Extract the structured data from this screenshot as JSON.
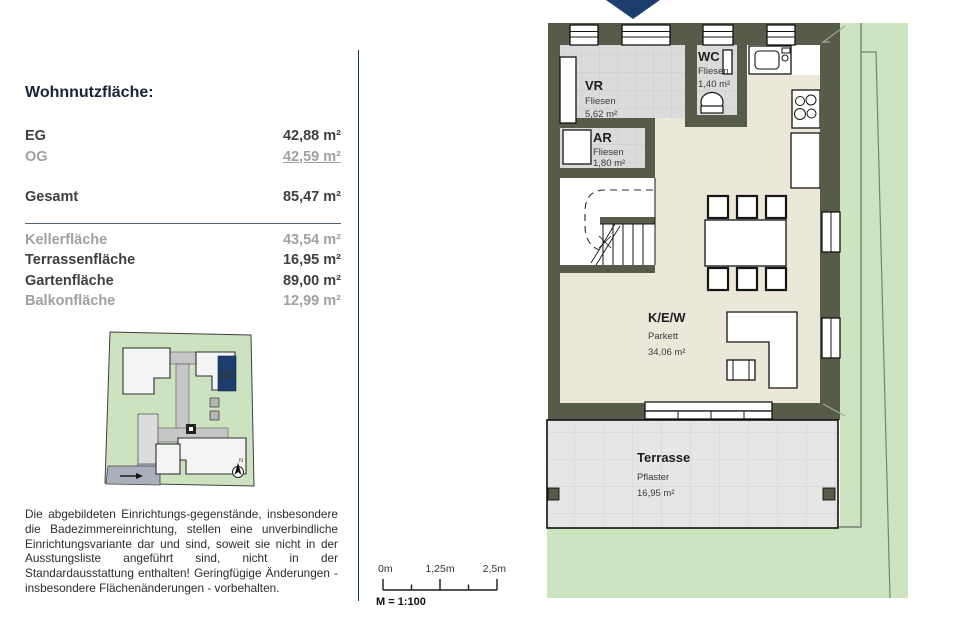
{
  "panel": {
    "title": "Wohnnutzfläche:",
    "rows": [
      {
        "label": "EG",
        "value": "42,88 m²"
      },
      {
        "label": "OG",
        "value": "42,59 m²"
      },
      {
        "label": "Gesamt",
        "value": "85,47 m²"
      },
      {
        "label": "Kellerfläche",
        "value": "43,54 m²"
      },
      {
        "label": "Terrassenfläche",
        "value": "16,95 m²"
      },
      {
        "label": "Gartenfläche",
        "value": "89,00 m²"
      },
      {
        "label": "Balkonfläche",
        "value": "12,99 m²"
      }
    ],
    "disclaimer": "Die abgebildeten Einrichtungs-gegenstände, insbesondere die Badezimmereinrichtung, stellen eine unverbindliche Einrichtungsvariante dar und sind, soweit sie nicht in der Ausstungsliste angeführt sind, nicht in der Standardausstattung enthalten! Geringfügige Änderungen - insbesondere Flächenänderungen - vorbehalten."
  },
  "siteplan": {
    "unit_label": "B2",
    "north_label": "N"
  },
  "scalebar": {
    "tick_labels": [
      "0m",
      "1,25m",
      "2,5m"
    ],
    "scale_label": "M = 1:100"
  },
  "floorplan": {
    "rooms": {
      "vr": {
        "name": "VR",
        "floor": "Fliesen",
        "area": "5,62 m²"
      },
      "wc": {
        "name": "WC",
        "floor": "Fliesen",
        "area": "1,40 m²"
      },
      "ar": {
        "name": "AR",
        "floor": "Fliesen",
        "area": "1,80 m²"
      },
      "kew": {
        "name": "K/E/W",
        "floor": "Parkett",
        "area": "34,06 m²"
      },
      "terrasse": {
        "name": "Terrasse",
        "floor": "Pflaster",
        "area": "16,95 m²"
      }
    }
  },
  "colors": {
    "accent_navy": "#1c3e6e",
    "wall": "#575b49",
    "garden": "#cde4c0",
    "tile_floor": "#dbdbdb",
    "parquet_floor": "#ece8d9",
    "terrace_floor": "#e6e6e6"
  }
}
